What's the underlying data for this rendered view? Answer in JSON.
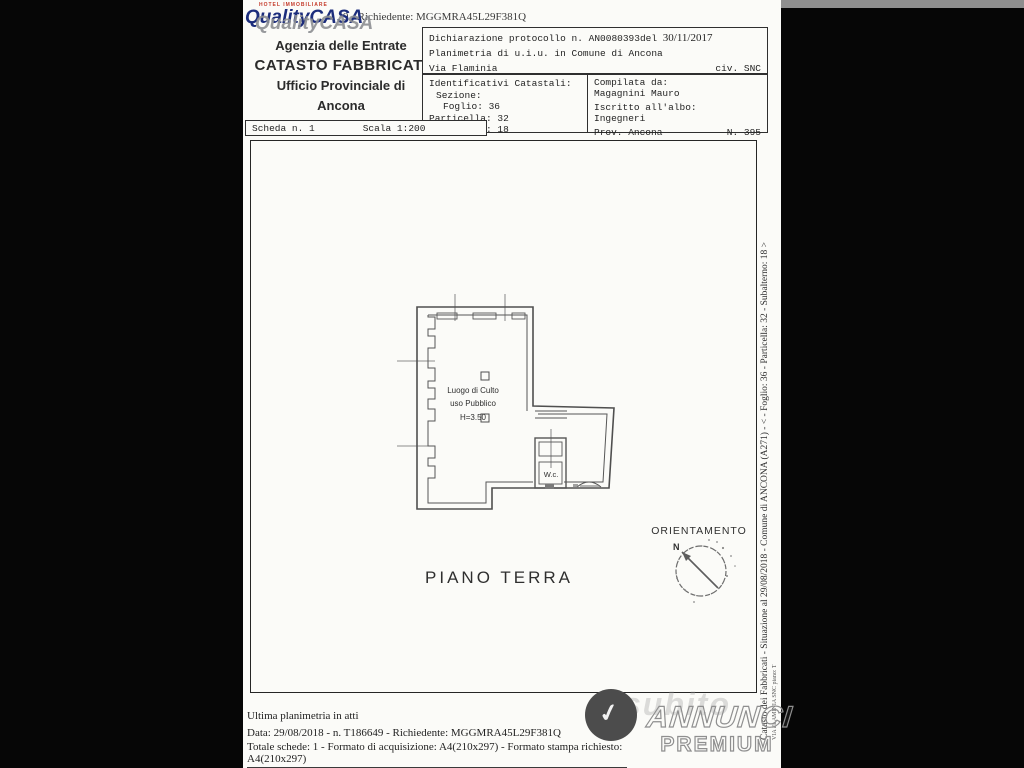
{
  "colors": {
    "paper": "#fbfbf8",
    "scan_background": "#060606",
    "plan_line": "#565656",
    "logo_navy": "#1c2d7c",
    "logo_red": "#c43a2a",
    "logo_gray": "#8d8f93"
  },
  "logo": {
    "brand": "QualityCASA",
    "tagline": "HOTEL IMMOBILIARE"
  },
  "header": {
    "request_line": "9 - Richiedente: MGGMRA45L29F381Q",
    "agency_line1": "Agenzia delle Entrate",
    "agency_line2": "CATASTO FABBRICATI",
    "agency_line3": "Ufficio Provinciale di",
    "agency_line4": "Ancona"
  },
  "declaration": {
    "protocol_label": "Dichiarazione protocollo n.",
    "protocol_number": "AN0080393del",
    "protocol_date": "30/11/2017",
    "line2": "Planimetria di u.i.u. in Comune di Ancona",
    "street": "Via Flaminia",
    "civic": "civ. SNC"
  },
  "identifiers": {
    "title": "Identificativi Catastali:",
    "sezione": "Sezione:",
    "foglio": "Foglio: 36",
    "particella": "Particella: 32",
    "subalterno": "Subalterno: 18"
  },
  "compiler": {
    "label": "Compilata da:",
    "name": "Magagnini Mauro",
    "albo_label": "Iscritto all'albo:",
    "albo": "Ingegneri",
    "province": "Prov. Ancona",
    "number": "N. 395"
  },
  "scheda": {
    "scheda": "Scheda n. 1",
    "scala": "Scala 1:200"
  },
  "plan": {
    "room_line1": "Luogo di Culto",
    "room_line2": "uso Pubblico",
    "room_line3": "H=3.50",
    "wc": "W.c.",
    "floor": "PIANO TERRA",
    "orientation": "ORIENTAMENTO",
    "north": "N"
  },
  "footer": {
    "line1": "Ultima planimetria in atti",
    "line2": "Data: 29/08/2018 - n. T186649 - Richiedente: MGGMRA45L29F381Q",
    "line3": "Totale schede: 1 - Formato di acquisizione: A4(210x297)  - Formato stampa richiesto: A4(210x297)"
  },
  "sidebar": {
    "vertical_line1": "Catasto dei Fabbricati - Situazione al 29/08/2018 - Comune di ANCONA (A271) - < - Foglio: 36 - Particella: 32 - Subalterno: 18 >",
    "vertical_line2": "VIA FLAMINIA SNC piano: T"
  },
  "watermark": {
    "brand_mark": "✓",
    "annunci": "ANNUNCI",
    "premium": "PREMIUM"
  }
}
